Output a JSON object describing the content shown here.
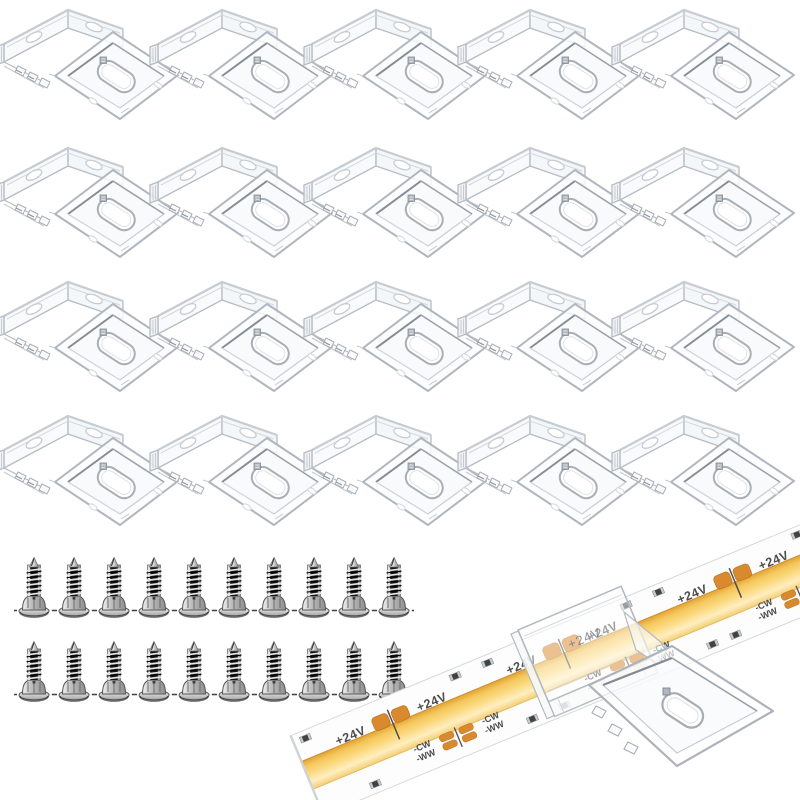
{
  "scene": {
    "background": "#ffffff",
    "clips": {
      "count": 20,
      "rows": 4,
      "cols": 5,
      "item_name": "clear LED strip mounting clip"
    },
    "screws": {
      "count": 20,
      "rows": 2,
      "per_row": 10,
      "item_name": "self-tapping screw"
    },
    "strip": {
      "item_name": "COB LED strip",
      "labels": {
        "positive": "+24V",
        "cool_white": "-CW",
        "warm_white": "-WW"
      },
      "colors": {
        "pcb": "#fdfdfd",
        "cob_dark": "#e2a335",
        "cob_gold": "#f4c75c",
        "cob_mid": "#fbd97f",
        "cob_light": "#ffeec0",
        "cob_low": "#f3cf76",
        "pad": "#d9892e",
        "pad_edge": "#b96f1f",
        "silk_text": "#4d4d4d"
      }
    },
    "clip_colors": {
      "stroke": "#b6bcc3",
      "stroke_dark": "#868d94",
      "fill": "#fbfdfe"
    },
    "screw_colors": {
      "metal": "#c9c9c9",
      "core": "#151515",
      "outline": "#6e6e6e"
    }
  }
}
